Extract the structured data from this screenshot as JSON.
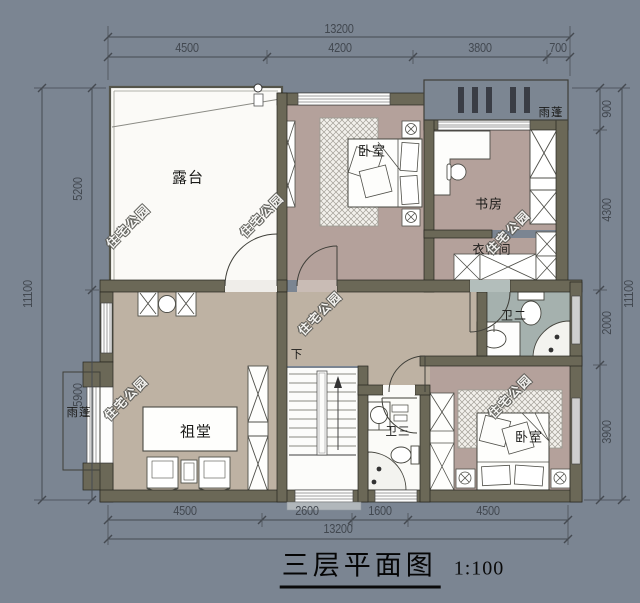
{
  "title": {
    "text": "三层平面图",
    "scale": "1:100"
  },
  "watermark_text": "住宅公园",
  "rooms": {
    "terrace": "露台",
    "bedroom_top": "卧室",
    "study": "书房",
    "cloakroom": "衣帽间",
    "bath_2": "卫二",
    "ancestral_hall": "祖堂",
    "bath_3": "卫三",
    "bedroom_bottom": "卧室",
    "canopy_top": "雨蓬",
    "canopy_left": "雨蓬",
    "stair_down": "下"
  },
  "dimensions": {
    "top": {
      "total": "13200",
      "segments": [
        "4500",
        "4200",
        "3800",
        "700"
      ]
    },
    "bottom": {
      "total": "13200",
      "segments": [
        "4500",
        "2600",
        "1600",
        "4500"
      ]
    },
    "left": {
      "total": "11100",
      "segments": [
        "5200",
        "5900"
      ]
    },
    "right": {
      "total": "11100",
      "segments": [
        "900",
        "4300",
        "2000",
        "3900"
      ]
    }
  },
  "colors": {
    "background": "#7b8592",
    "wall": "#6b6857",
    "room_warm": "#b4a19b",
    "room_tan": "#beb2a3",
    "room_bath": "#a5b1ae",
    "terrace_white": "#fbfaf7",
    "dimension_text": "#424850"
  }
}
